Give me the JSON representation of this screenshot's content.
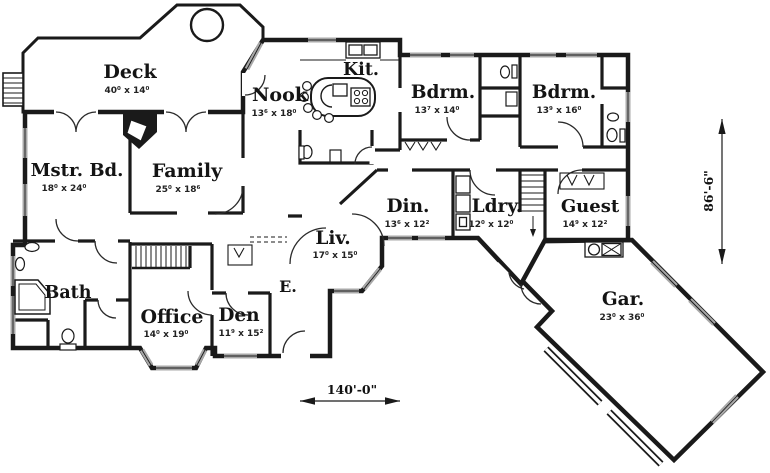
{
  "plan": {
    "type": "single-level house floor plan",
    "rooms": {
      "deck": {
        "name": "Deck",
        "dims": "40⁰ x 14⁰"
      },
      "nook": {
        "name": "Nook",
        "dims": "13⁶ x 18⁰"
      },
      "kitchen": {
        "name": "Kit.",
        "dims": ""
      },
      "bedroom1": {
        "name": "Bdrm.",
        "dims": "13⁷ x 14⁰"
      },
      "bedroom2": {
        "name": "Bdrm.",
        "dims": "13⁹ x 16⁰"
      },
      "master": {
        "name": "Mstr. Bd.",
        "dims": "18⁰ x 24⁰"
      },
      "family": {
        "name": "Family",
        "dims": "25⁰ x 18⁶"
      },
      "dining": {
        "name": "Din.",
        "dims": "13⁶ x 12²"
      },
      "laundry": {
        "name": "Ldry.",
        "dims": "12⁰ x 12⁰"
      },
      "guest": {
        "name": "Guest",
        "dims": "14⁹ x 12²"
      },
      "bath": {
        "name": "Bath",
        "dims": ""
      },
      "office": {
        "name": "Office",
        "dims": "14⁰ x 19⁰"
      },
      "den": {
        "name": "Den",
        "dims": "11⁹ x 15²"
      },
      "living": {
        "name": "Liv.",
        "dims": "17⁰ x 15⁰"
      },
      "entry": {
        "name": "E.",
        "dims": ""
      },
      "garage": {
        "name": "Gar.",
        "dims": "23⁰ x 36⁰"
      }
    },
    "overall_dimensions": {
      "width": "140'-0\"",
      "depth": "86'-6\""
    },
    "fixtures": [
      "hot-tub",
      "deck-stairs",
      "fireplace",
      "kitchen-island",
      "bar-stools",
      "kitchen-sink",
      "range",
      "toilet",
      "pedestal-sink",
      "corner-tub",
      "washer-dryer-cabinets",
      "upper-staircase",
      "lower-staircase",
      "garage-door-panels",
      "utility-area",
      "closet-rod-chevrons",
      "entry-door",
      "window",
      "door-swing"
    ],
    "colors": {
      "wall": "#1a1a1a",
      "window": "#a8a8a8",
      "background": "#ffffff"
    }
  }
}
